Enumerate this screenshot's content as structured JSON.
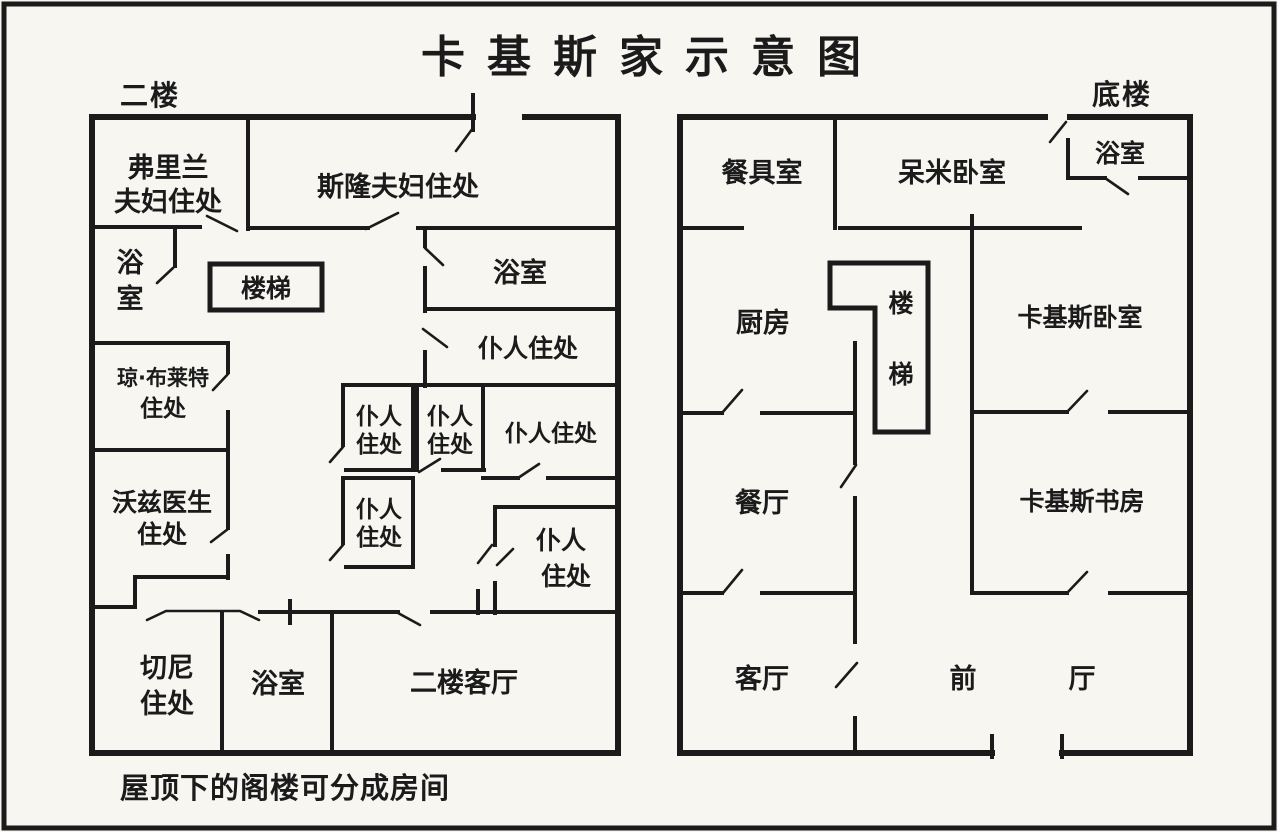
{
  "title": "卡基斯家示意图",
  "colors": {
    "ink": "#1b1b1b",
    "paper": "#f7f6f1"
  },
  "left_plan": {
    "floor_label": "二楼",
    "note": "屋顶下的阁楼可分成房间",
    "rooms": {
      "freeland_line1": "弗里兰",
      "freeland_line2": "夫妇住处",
      "sloane": "斯隆夫妇住处",
      "bath_left_line1": "浴",
      "bath_left_line2": "室",
      "stairs": "楼梯",
      "bath_right": "浴室",
      "servant_a": "仆人住处",
      "joan_line1": "琼·布莱特",
      "joan_line2": "住处",
      "wardes_line1": "沃兹医生",
      "wardes_line2": "住处",
      "servant_b1_line1": "仆人",
      "servant_b1_line2": "住处",
      "servant_b2_line1": "仆人",
      "servant_b2_line2": "住处",
      "servant_c": "仆人住处",
      "servant_d_line1": "仆人",
      "servant_d_line2": "住处",
      "servant_e_line1": "仆人",
      "servant_e_line2": "住处",
      "cheney_line1": "切尼",
      "cheney_line2": "住处",
      "bath_bottom": "浴室",
      "living_room_2f": "二楼客厅"
    }
  },
  "right_plan": {
    "floor_label": "底楼",
    "rooms": {
      "pantry": "餐具室",
      "demmy_bedroom": "呆米卧室",
      "bath": "浴室",
      "kitchen": "厨房",
      "stairs_line1": "楼",
      "stairs_line2": "梯",
      "khalkis_bedroom": "卡基斯卧室",
      "dining": "餐厅",
      "khalkis_study": "卡基斯书房",
      "parlor": "客厅",
      "front_hall_char1": "前",
      "front_hall_char2": "厅"
    }
  }
}
